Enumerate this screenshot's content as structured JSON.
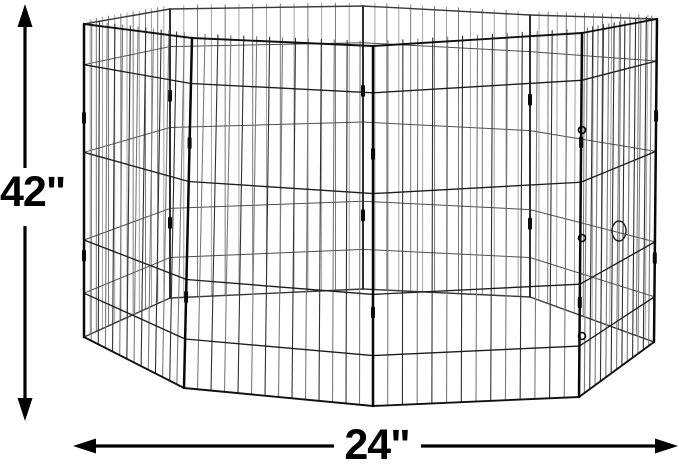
{
  "page": {
    "background_color": "#ffffff",
    "annotation_color": "#000000"
  },
  "illustration": {
    "subject": "octagonal wire pet exercise pen",
    "panel_count": 8,
    "wire_color_front": "#1c1c1c",
    "wire_color_back": "#6b6b6b"
  },
  "dimensions": {
    "height_label": "42\"",
    "width_label": "24\""
  }
}
